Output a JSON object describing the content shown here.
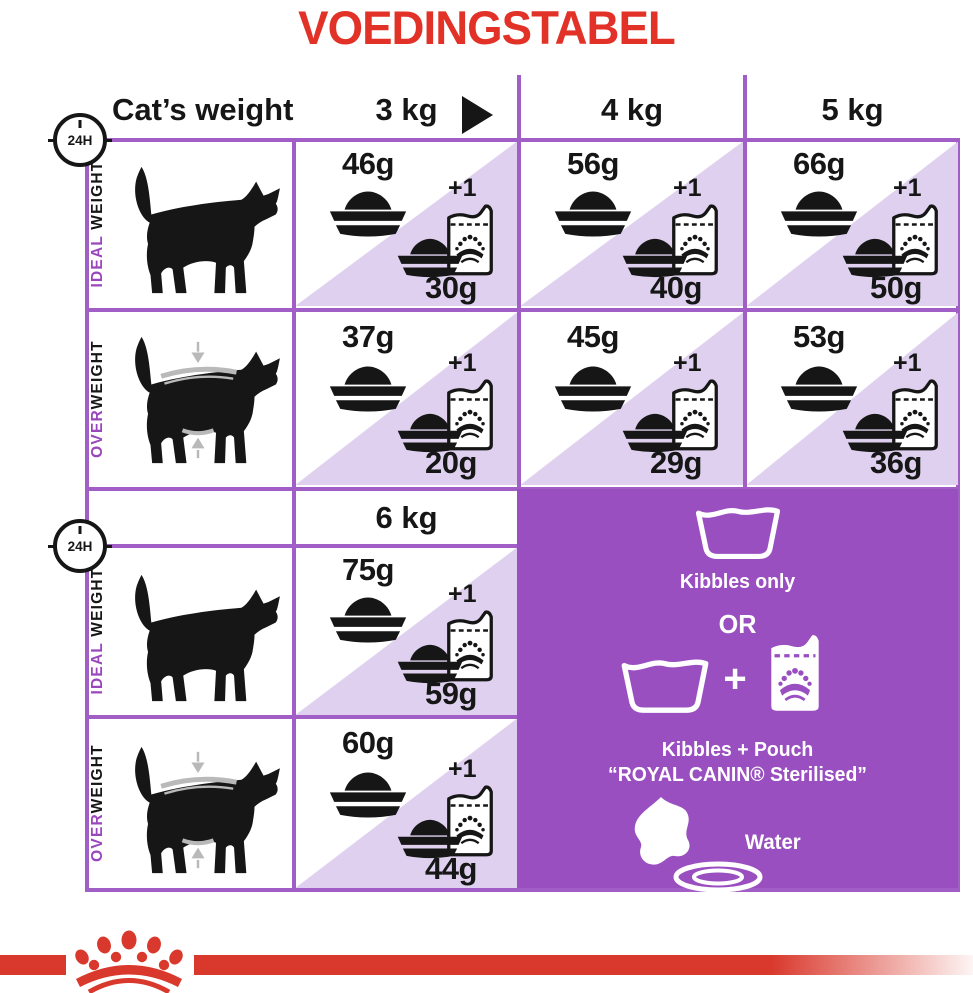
{
  "title": "VOEDINGSTABEL",
  "colors": {
    "title_red": "#e23228",
    "band_red": "#d9382c",
    "grid_purple": "#a05ec6",
    "panel_purple": "#9a4fc1",
    "triangle_lavender": "#ded0ee",
    "label_accent_purple": "#9a46bd"
  },
  "header": {
    "cats_weight_label": "Cat’s weight",
    "clock_label": "24H",
    "columns": [
      "3 kg",
      "4 kg",
      "5 kg"
    ],
    "column_extra": "6 kg"
  },
  "row_labels": {
    "ideal_accent": "IDEAL",
    "ideal_rest": " WEIGHT",
    "over_accent": "OVER",
    "over_rest": "WEIGHT"
  },
  "plus_one": "+1",
  "cells": {
    "ideal_3": {
      "dry": "46g",
      "mix": "30g"
    },
    "ideal_4": {
      "dry": "56g",
      "mix": "40g"
    },
    "ideal_5": {
      "dry": "66g",
      "mix": "50g"
    },
    "ideal_6": {
      "dry": "75g",
      "mix": "59g"
    },
    "over_3": {
      "dry": "37g",
      "mix": "20g"
    },
    "over_4": {
      "dry": "45g",
      "mix": "29g"
    },
    "over_5": {
      "dry": "53g",
      "mix": "36g"
    },
    "over_6": {
      "dry": "60g",
      "mix": "44g"
    }
  },
  "panel": {
    "kibbles_only": "Kibbles only",
    "or": "OR",
    "plus": "+",
    "kibbles_pouch_line1": "Kibbles + Pouch",
    "kibbles_pouch_line2": "“ROYAL CANIN® Sterilised”",
    "water": "Water"
  },
  "chart_data": {
    "type": "table",
    "title": "VOEDINGSTABEL",
    "unit": "grams per 24H",
    "columns": [
      "3 kg",
      "4 kg",
      "5 kg",
      "6 kg"
    ],
    "rows": [
      {
        "label": "IDEAL WEIGHT",
        "kibbles_only_g": [
          46,
          56,
          66,
          75
        ],
        "kibbles_plus_1_pouch_g": [
          30,
          40,
          50,
          59
        ]
      },
      {
        "label": "OVERWEIGHT",
        "kibbles_only_g": [
          37,
          45,
          53,
          60
        ],
        "kibbles_plus_1_pouch_g": [
          20,
          29,
          36,
          44
        ]
      }
    ],
    "notes": [
      "Rations are per 24H (cat's weight across columns)",
      "Diagonal cells: kibbles only OR kibbles + 1 pouch",
      "Kibbles only OR Kibbles + Pouch “ROYAL CANIN® Sterilised”",
      "Water always available"
    ]
  }
}
